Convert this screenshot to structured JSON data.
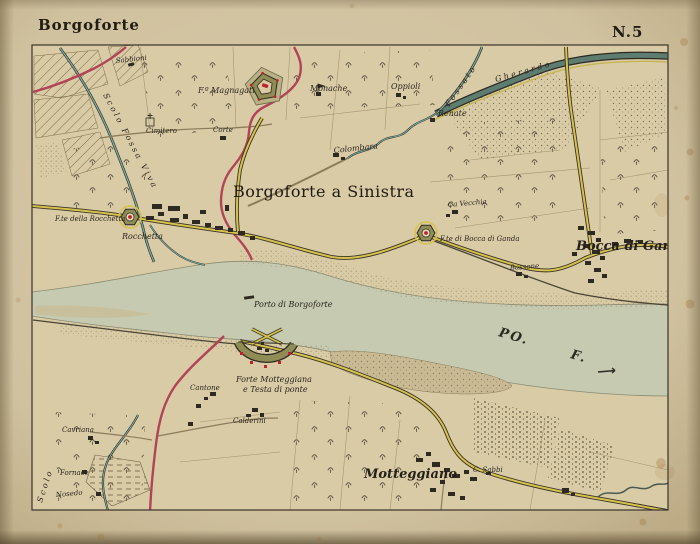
{
  "sheet": {
    "title": "Borgoforte",
    "number": "N.5"
  },
  "map": {
    "settlement_labels": {
      "borgoforte_a_sinistra": "Borgoforte a Sinistra",
      "bocca_di_ganda": "Bocca di Ganda",
      "motteggiano": "Motteggiano"
    },
    "river_labels": {
      "po": "PO.",
      "f": "F.",
      "porto": "Porto di Borgoforte"
    },
    "fort_labels": {
      "magnagati": "F.º Magnagati",
      "rocchetta_fort": "F.te della Rocchetta",
      "bocca_di_ganda_fort": "F.te di Bocca di Ganda",
      "motteggiana_line1": "Forte Motteggiana",
      "motteggiana_line2": "e Testa di ponte"
    },
    "locality_labels": {
      "sabbioni": "Sabbioni",
      "monache": "Monache",
      "oppioli": "Oppioli",
      "renate": "Renate",
      "colombara": "Colombara",
      "cimitero": "Cimitero",
      "corte": "Corte",
      "rocchetta": "Rocchetta",
      "ca_vecchia": "Ca Vecchia",
      "bassone": "Bassone",
      "cantone": "Cantone",
      "calderini": "Calderini",
      "cavriana": "Cavriana",
      "fornace": "Fornace",
      "nosedo": "Nosedo",
      "c_sabbi": "C. Sabbi"
    },
    "water_labels": {
      "gherardo": "Gherardo",
      "fossato": "Fossato",
      "scolo_fossa_viva": "Scolo Fossa Viva",
      "scolo": "Scolo"
    },
    "colors": {
      "paper": "#d2c3a2",
      "map_field": "#d9cba6",
      "river": "#c5cab0",
      "canal": "#5d7d70",
      "stream": "#7aa89e",
      "road_red": "#b24457",
      "road_yellow": "#d6c24e",
      "fort_green": "#8f8c55",
      "ink": "#2b2620",
      "accent_red": "#c0202a"
    }
  }
}
